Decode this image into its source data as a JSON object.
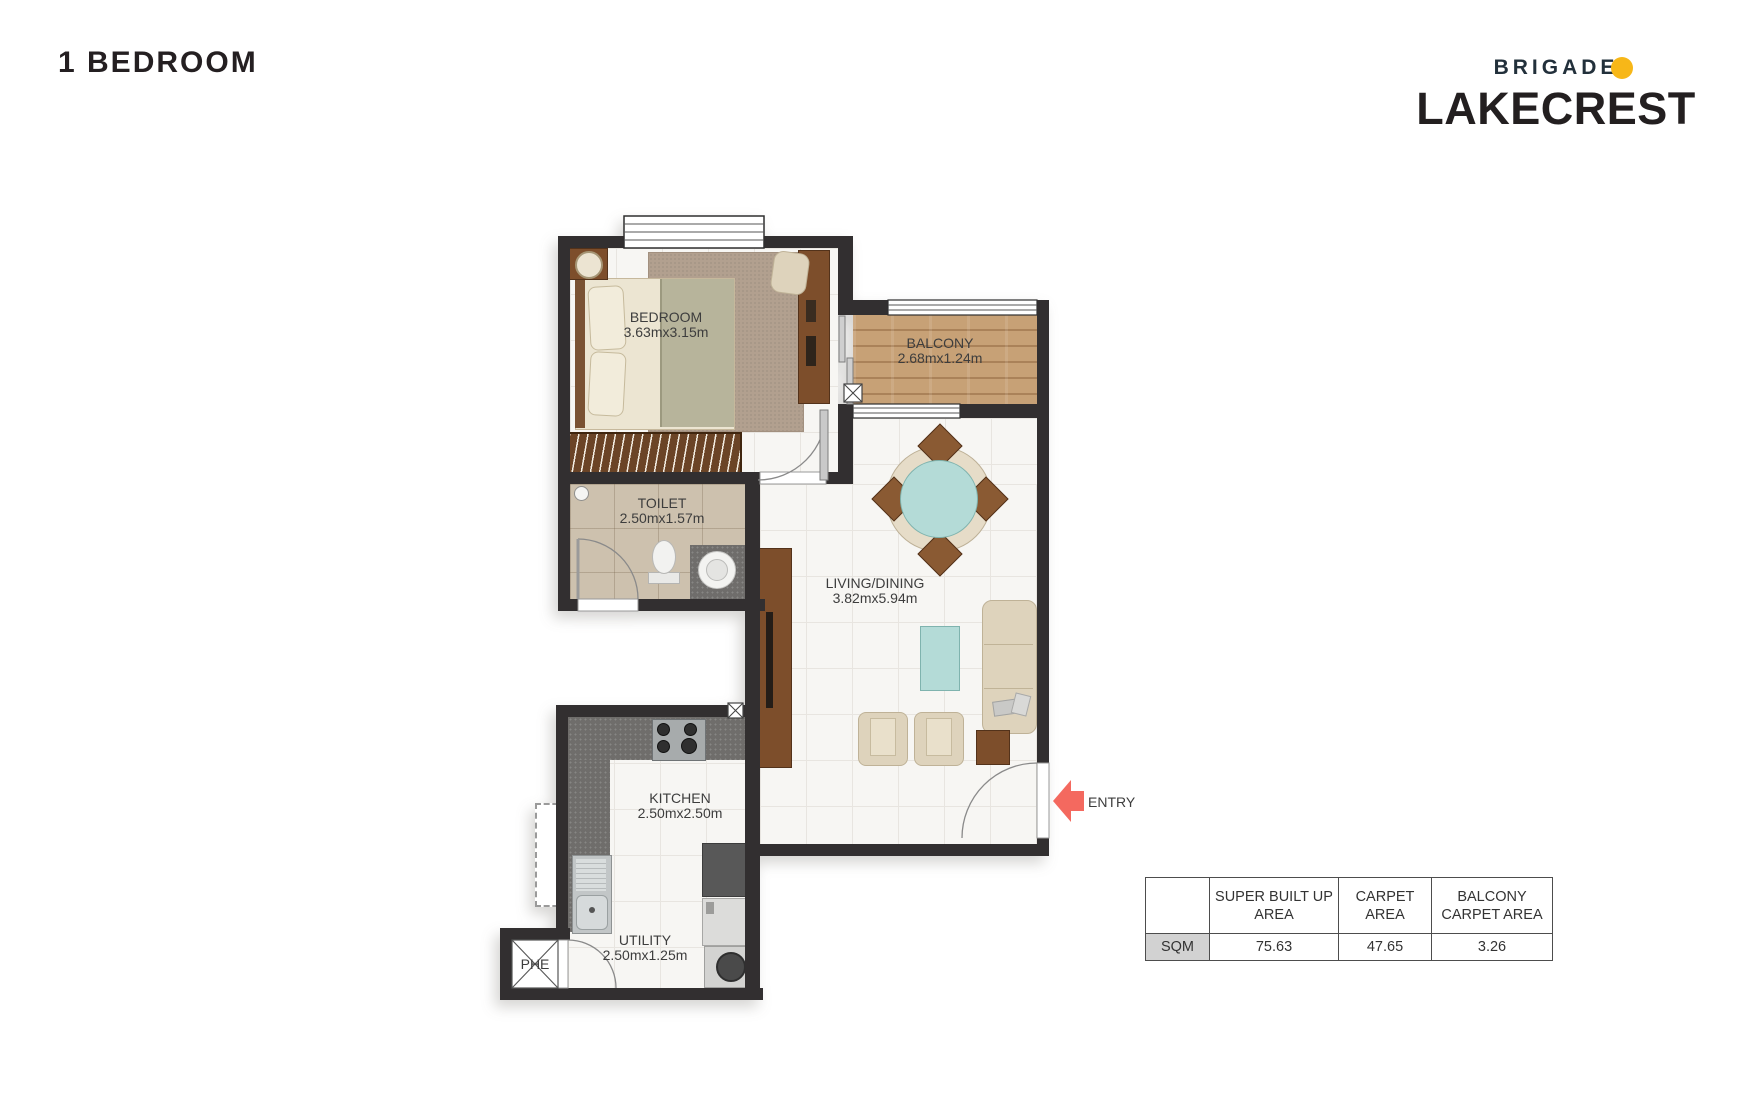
{
  "page": {
    "title": "1 BEDROOM"
  },
  "logo": {
    "brand": "BRIGADE",
    "project": "LAKECREST",
    "dot_color": "#F7B718",
    "brand_color": "#22303B",
    "project_color": "#231F20"
  },
  "floorplan": {
    "wall_color": "#322F30",
    "entry_arrow_color": "#F4695F",
    "rooms": [
      {
        "id": "bedroom",
        "name": "BEDROOM",
        "dims": "3.63mx3.15m"
      },
      {
        "id": "balcony",
        "name": "BALCONY",
        "dims": "2.68mx1.24m"
      },
      {
        "id": "toilet",
        "name": "TOILET",
        "dims": "2.50mx1.57m"
      },
      {
        "id": "living",
        "name": "LIVING/DINING",
        "dims": "3.82mx5.94m"
      },
      {
        "id": "kitchen",
        "name": "KITCHEN",
        "dims": "2.50mx2.50m"
      },
      {
        "id": "utility",
        "name": "UTILITY",
        "dims": "2.50mx1.25m"
      }
    ],
    "entry_label": "ENTRY",
    "phe_label": "PHE"
  },
  "area_table": {
    "col_headers": [
      "SUPER BUILT UP AREA",
      "CARPET AREA",
      "BALCONY CARPET AREA"
    ],
    "row_header": "SQM",
    "values": [
      "75.63",
      "47.65",
      "3.26"
    ]
  }
}
